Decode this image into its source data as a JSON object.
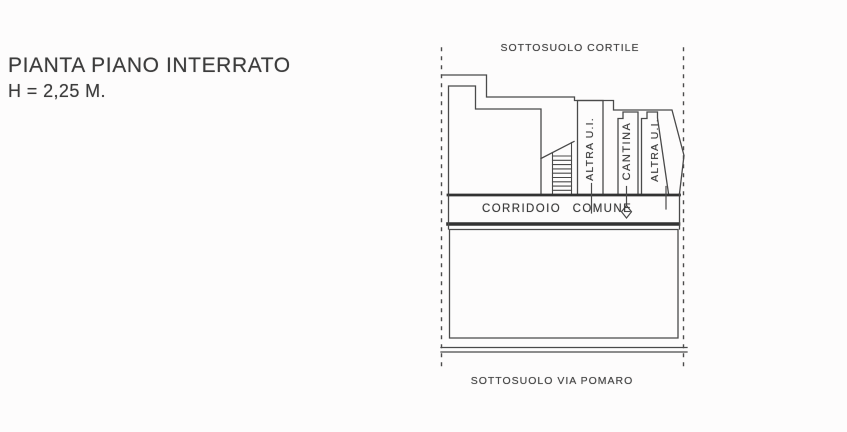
{
  "document": {
    "type": "scanned-floor-plan",
    "title_line1": "PIANTA PIANO INTERRATO",
    "title_line2": "H = 2,25 M."
  },
  "plan": {
    "top_boundary_label": "SOTTOSUOLO CORTILE",
    "bottom_boundary_label": "SOTTOSUOLO VIA POMARO",
    "corridor_label": "CORRIDOIO COMUNE",
    "rooms": [
      {
        "label": "ALTRA U.I."
      },
      {
        "label": "CANTINA"
      },
      {
        "label": "ALTRA U.I."
      }
    ],
    "icons": {
      "corridor_diamond": "open-diamond-door-marker",
      "staircase": "hatched-stair-run"
    },
    "colors": {
      "paper": "#fdfcfc",
      "ink": "#4a4a4a",
      "ink_dark": "#323232",
      "text": "#3c3c3c"
    }
  }
}
